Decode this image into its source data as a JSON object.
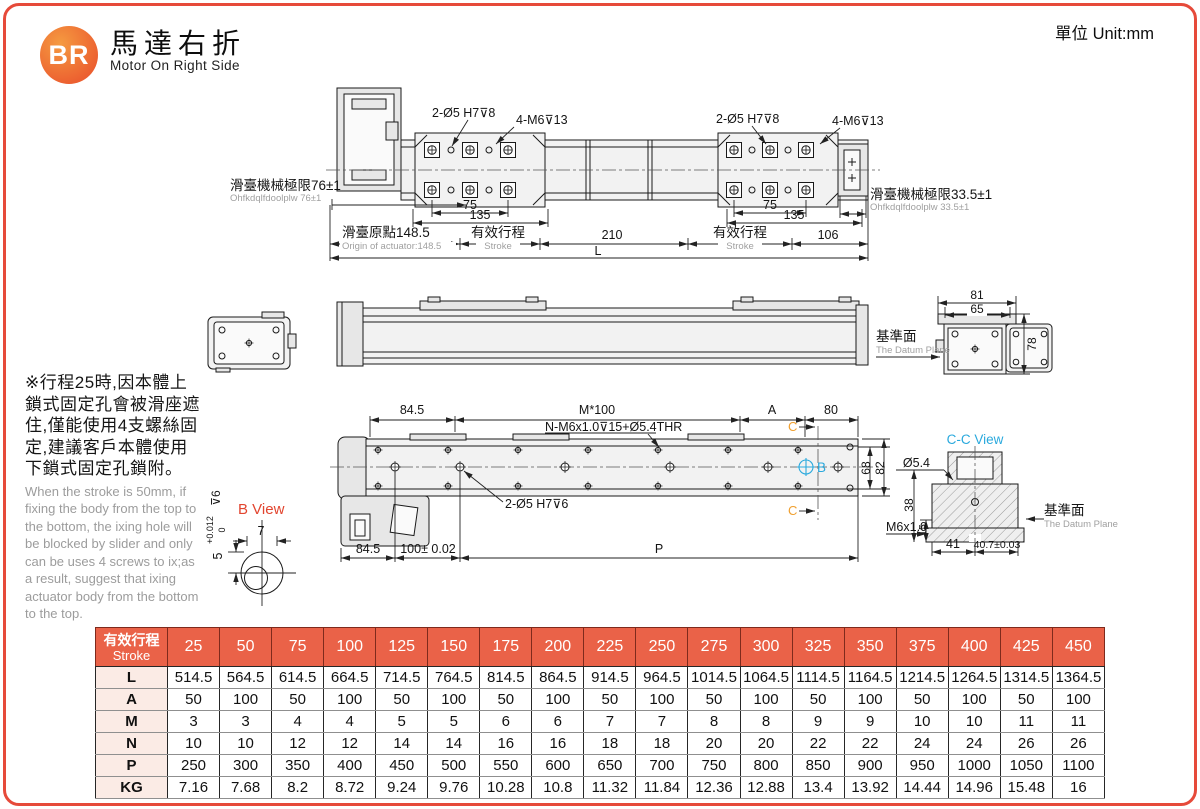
{
  "header": {
    "logo": "BR",
    "title_zh": "馬達右折",
    "title_en": "Motor On Right Side",
    "unit": "單位 Unit:mm"
  },
  "colors": {
    "accent": "#e64a3a",
    "table_header_bg": "#ea6248",
    "table_label_bg": "#fbebe5",
    "cyan": "#2aa9dd",
    "orange": "#f0a030",
    "note_gray": "#9c9c9c"
  },
  "note": {
    "zh": "※行程25時,因本體上鎖式固定孔會被滑座遮住,僅能使用4支螺絲固定,建議客戶本體使用下鎖式固定孔鎖附。",
    "en": "When the stroke is 50mm, if fixing the body from the top to the bottom, the ixing hole will be blocked by slider and only can be uses 4 screws to ix;as a result, suggest that ixing actuator body from the bottom to the top."
  },
  "drawing": {
    "hole8": "2-Ø5 H7⊽8",
    "thread13": "4-M6⊽13",
    "hole6": "2-Ø5 H7⊽6",
    "limit_left_zh": "滑臺機械極限76±1",
    "limit_left_en": "Ohfkdqlfdoolplw 76±1",
    "limit_right_zh": "滑臺機械極限33.5±1",
    "limit_right_en": "Ohfkdqlfdoolplw 33.5±1",
    "origin_zh": "滑臺原點148.5",
    "origin_en": "Origin of actuator:148.5",
    "stroke_zh": "有效行程",
    "stroke_en": "Stroke",
    "datum_zh": "基準面",
    "datum_en": "The Datum Plane",
    "d75": "75",
    "d135": "135",
    "d210": "210",
    "d106": "106",
    "dL": "L",
    "d81": "81",
    "d65": "65",
    "d78": "78",
    "d845": "84.5",
    "m100": "M*100",
    "n_label": "N-M6x1.0⊽15+Ø5.4THR",
    "dA": "A",
    "d80": "80",
    "dC": "C",
    "dB": "B",
    "d68": "68",
    "d82": "82",
    "d100": "100± 0.02",
    "dP": "P",
    "bview_title": "B View",
    "d7": "7",
    "tol_base": "5",
    "tol_plus": "+0.012",
    "tol_zero": "0",
    "tol_depth": "⊽6",
    "cc_title": "C-C View",
    "d54": "Ø5.4",
    "d38": "38",
    "d15": "15",
    "m6": "M6x1.0",
    "d41": "41",
    "d407": "40.7±0.03"
  },
  "table": {
    "header_zh": "有效行程",
    "header_en": "Stroke",
    "strokes": [
      "25",
      "50",
      "75",
      "100",
      "125",
      "150",
      "175",
      "200",
      "225",
      "250",
      "275",
      "300",
      "325",
      "350",
      "375",
      "400",
      "425",
      "450"
    ],
    "rows": [
      {
        "label": "L",
        "values": [
          "514.5",
          "564.5",
          "614.5",
          "664.5",
          "714.5",
          "764.5",
          "814.5",
          "864.5",
          "914.5",
          "964.5",
          "1014.5",
          "1064.5",
          "1114.5",
          "1164.5",
          "1214.5",
          "1264.5",
          "1314.5",
          "1364.5"
        ]
      },
      {
        "label": "A",
        "values": [
          "50",
          "100",
          "50",
          "100",
          "50",
          "100",
          "50",
          "100",
          "50",
          "100",
          "50",
          "100",
          "50",
          "100",
          "50",
          "100",
          "50",
          "100"
        ]
      },
      {
        "label": "M",
        "values": [
          "3",
          "3",
          "4",
          "4",
          "5",
          "5",
          "6",
          "6",
          "7",
          "7",
          "8",
          "8",
          "9",
          "9",
          "10",
          "10",
          "11",
          "11"
        ]
      },
      {
        "label": "N",
        "values": [
          "10",
          "10",
          "12",
          "12",
          "14",
          "14",
          "16",
          "16",
          "18",
          "18",
          "20",
          "20",
          "22",
          "22",
          "24",
          "24",
          "26",
          "26"
        ]
      },
      {
        "label": "P",
        "values": [
          "250",
          "300",
          "350",
          "400",
          "450",
          "500",
          "550",
          "600",
          "650",
          "700",
          "750",
          "800",
          "850",
          "900",
          "950",
          "1000",
          "1050",
          "1100"
        ]
      },
      {
        "label": "KG",
        "values": [
          "7.16",
          "7.68",
          "8.2",
          "8.72",
          "9.24",
          "9.76",
          "10.28",
          "10.8",
          "11.32",
          "11.84",
          "12.36",
          "12.88",
          "13.4",
          "13.92",
          "14.44",
          "14.96",
          "15.48",
          "16"
        ]
      }
    ]
  }
}
